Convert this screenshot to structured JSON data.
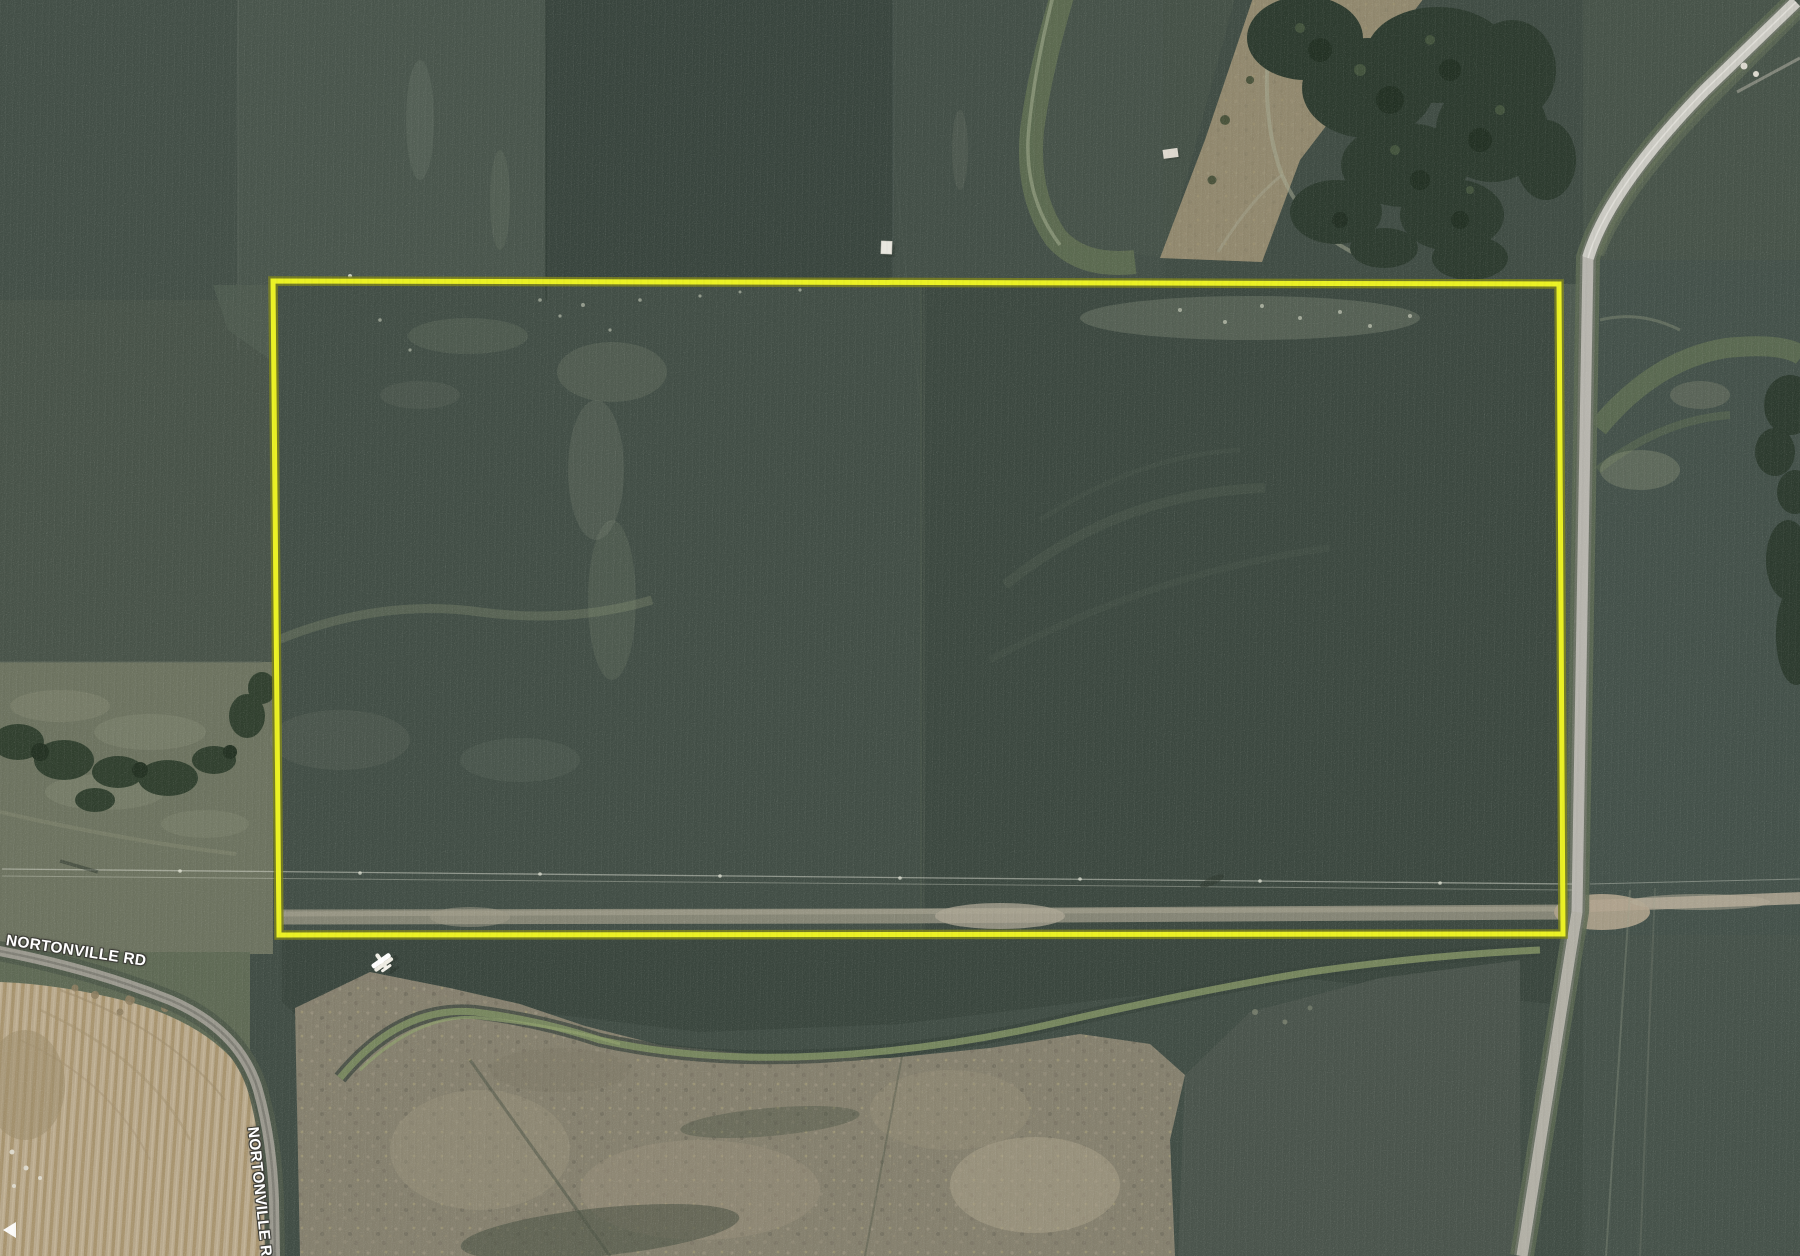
{
  "map": {
    "road_labels": {
      "west": "NORTONVILLE RD",
      "south": "NORTONVILLE RD"
    }
  },
  "theme": {
    "parcel_outline_color": "#ebf125",
    "parcel_outline_halo": "#7c8220",
    "label_text_color": "#ffffff",
    "label_outline_color": "#3d3d37"
  }
}
